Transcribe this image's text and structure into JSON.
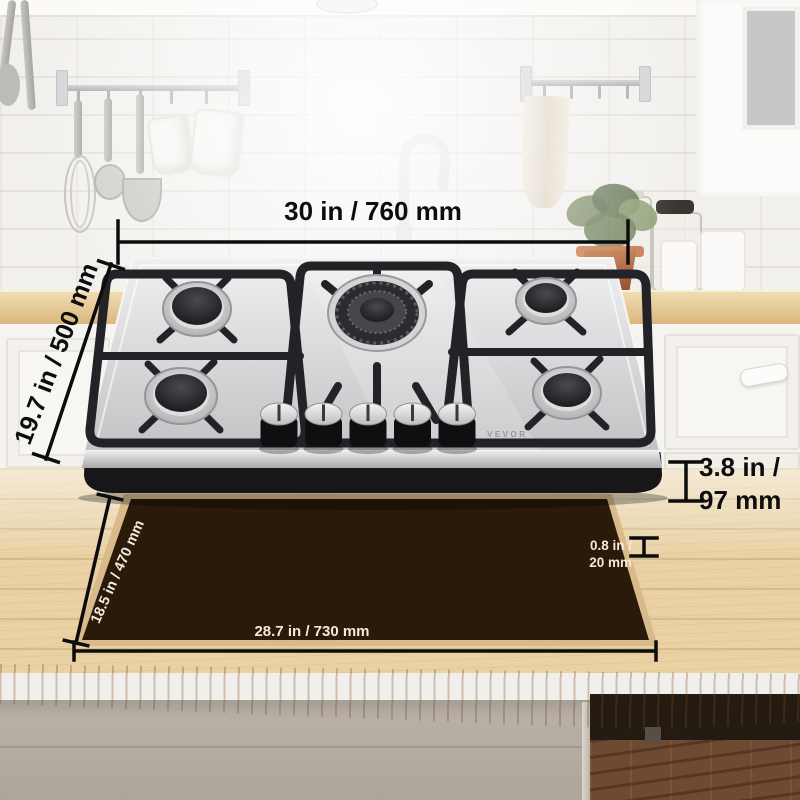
{
  "product": {
    "brand": "VEVOR"
  },
  "annotations": {
    "top_width": "30 in / 760 mm",
    "side_depth": "19.7 in / 500 mm",
    "body_height": [
      "3.8 in /",
      "97 mm"
    ],
    "mat_thickness": [
      "0.8 in /",
      "20 mm"
    ],
    "cutout_depth": "18.5 in / 470 mm",
    "cutout_width": "28.7 in / 730 mm"
  },
  "colors": {
    "annotation_black": "#0d0d0d",
    "annotation_white": "#f3ead8",
    "cutout_brown": "#2a1a09",
    "cutout_edge_tan": "#d9ba8c",
    "counter_wood": "#e9d1a4",
    "stainless": "#d9d9db",
    "grate_black": "#232327"
  }
}
